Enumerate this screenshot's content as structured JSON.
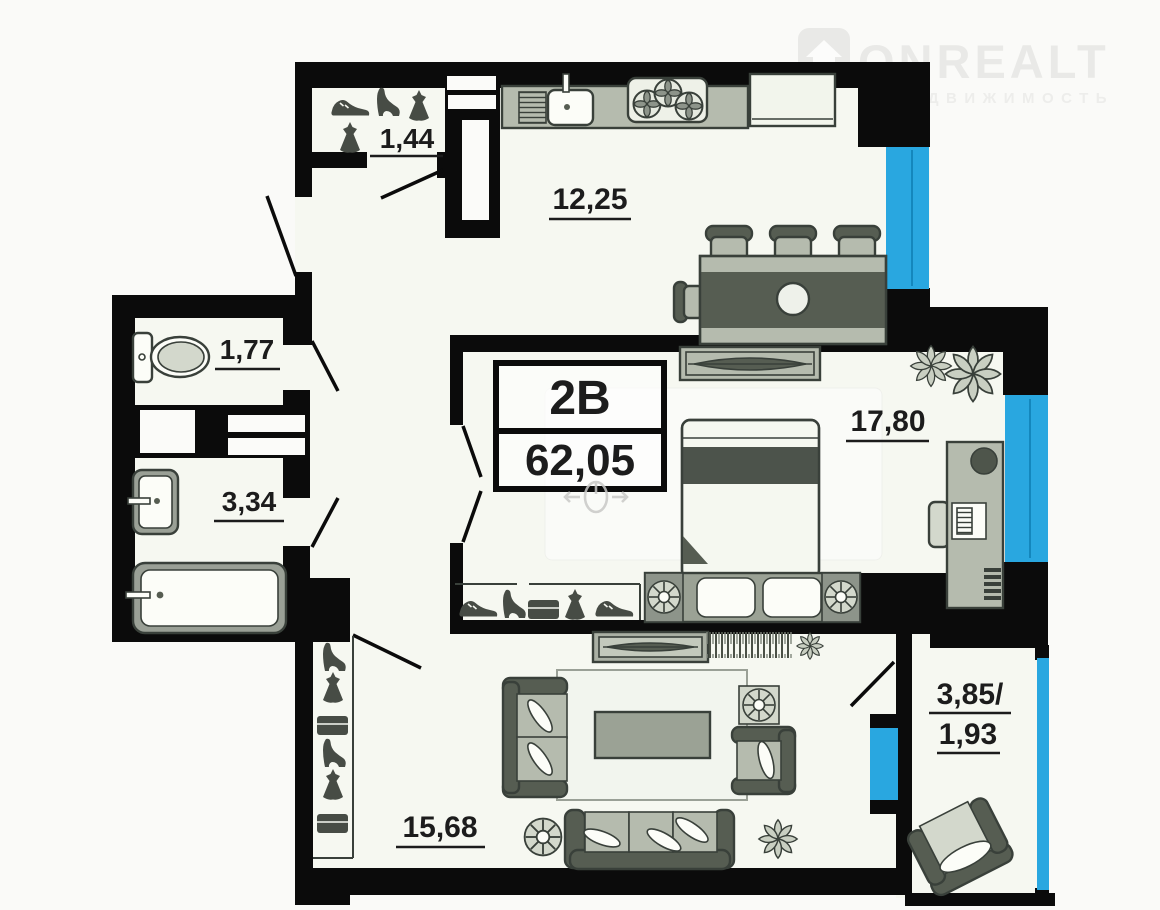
{
  "brand": {
    "name": "ONREALT",
    "tagline": "НЕДВИЖИМОСТЬ",
    "logo_icon": "house-icon"
  },
  "unit": {
    "plan_code": "2В",
    "total_area_m2": "62,05"
  },
  "rooms": {
    "closet": {
      "area": "1,44"
    },
    "kitchen": {
      "area": "12,25"
    },
    "toilet": {
      "area": "1,77"
    },
    "bathroom": {
      "area": "3,34"
    },
    "bedroom": {
      "area": "17,80"
    },
    "living": {
      "area": "15,68"
    },
    "balcony": {
      "area_full": "3,85/",
      "area_reduced": "1,93"
    }
  },
  "colors": {
    "wall": "#0b0b0b",
    "window": "#29a7e0",
    "window-line": "#1487bd",
    "paper": "#fafaf8",
    "floor": "#f6f8f1",
    "furn-dark": "#565d52",
    "furn-mid": "#b5bbae",
    "furn-light": "#d3d8cc",
    "furn-white": "#fcfdf8",
    "furn-line": "#39403a",
    "icon": "#474c45",
    "label": "#1c1c1c",
    "watermark": "#e9e9e7",
    "watermark-sub": "#ededeb",
    "mouse": "#c9c9c7"
  }
}
